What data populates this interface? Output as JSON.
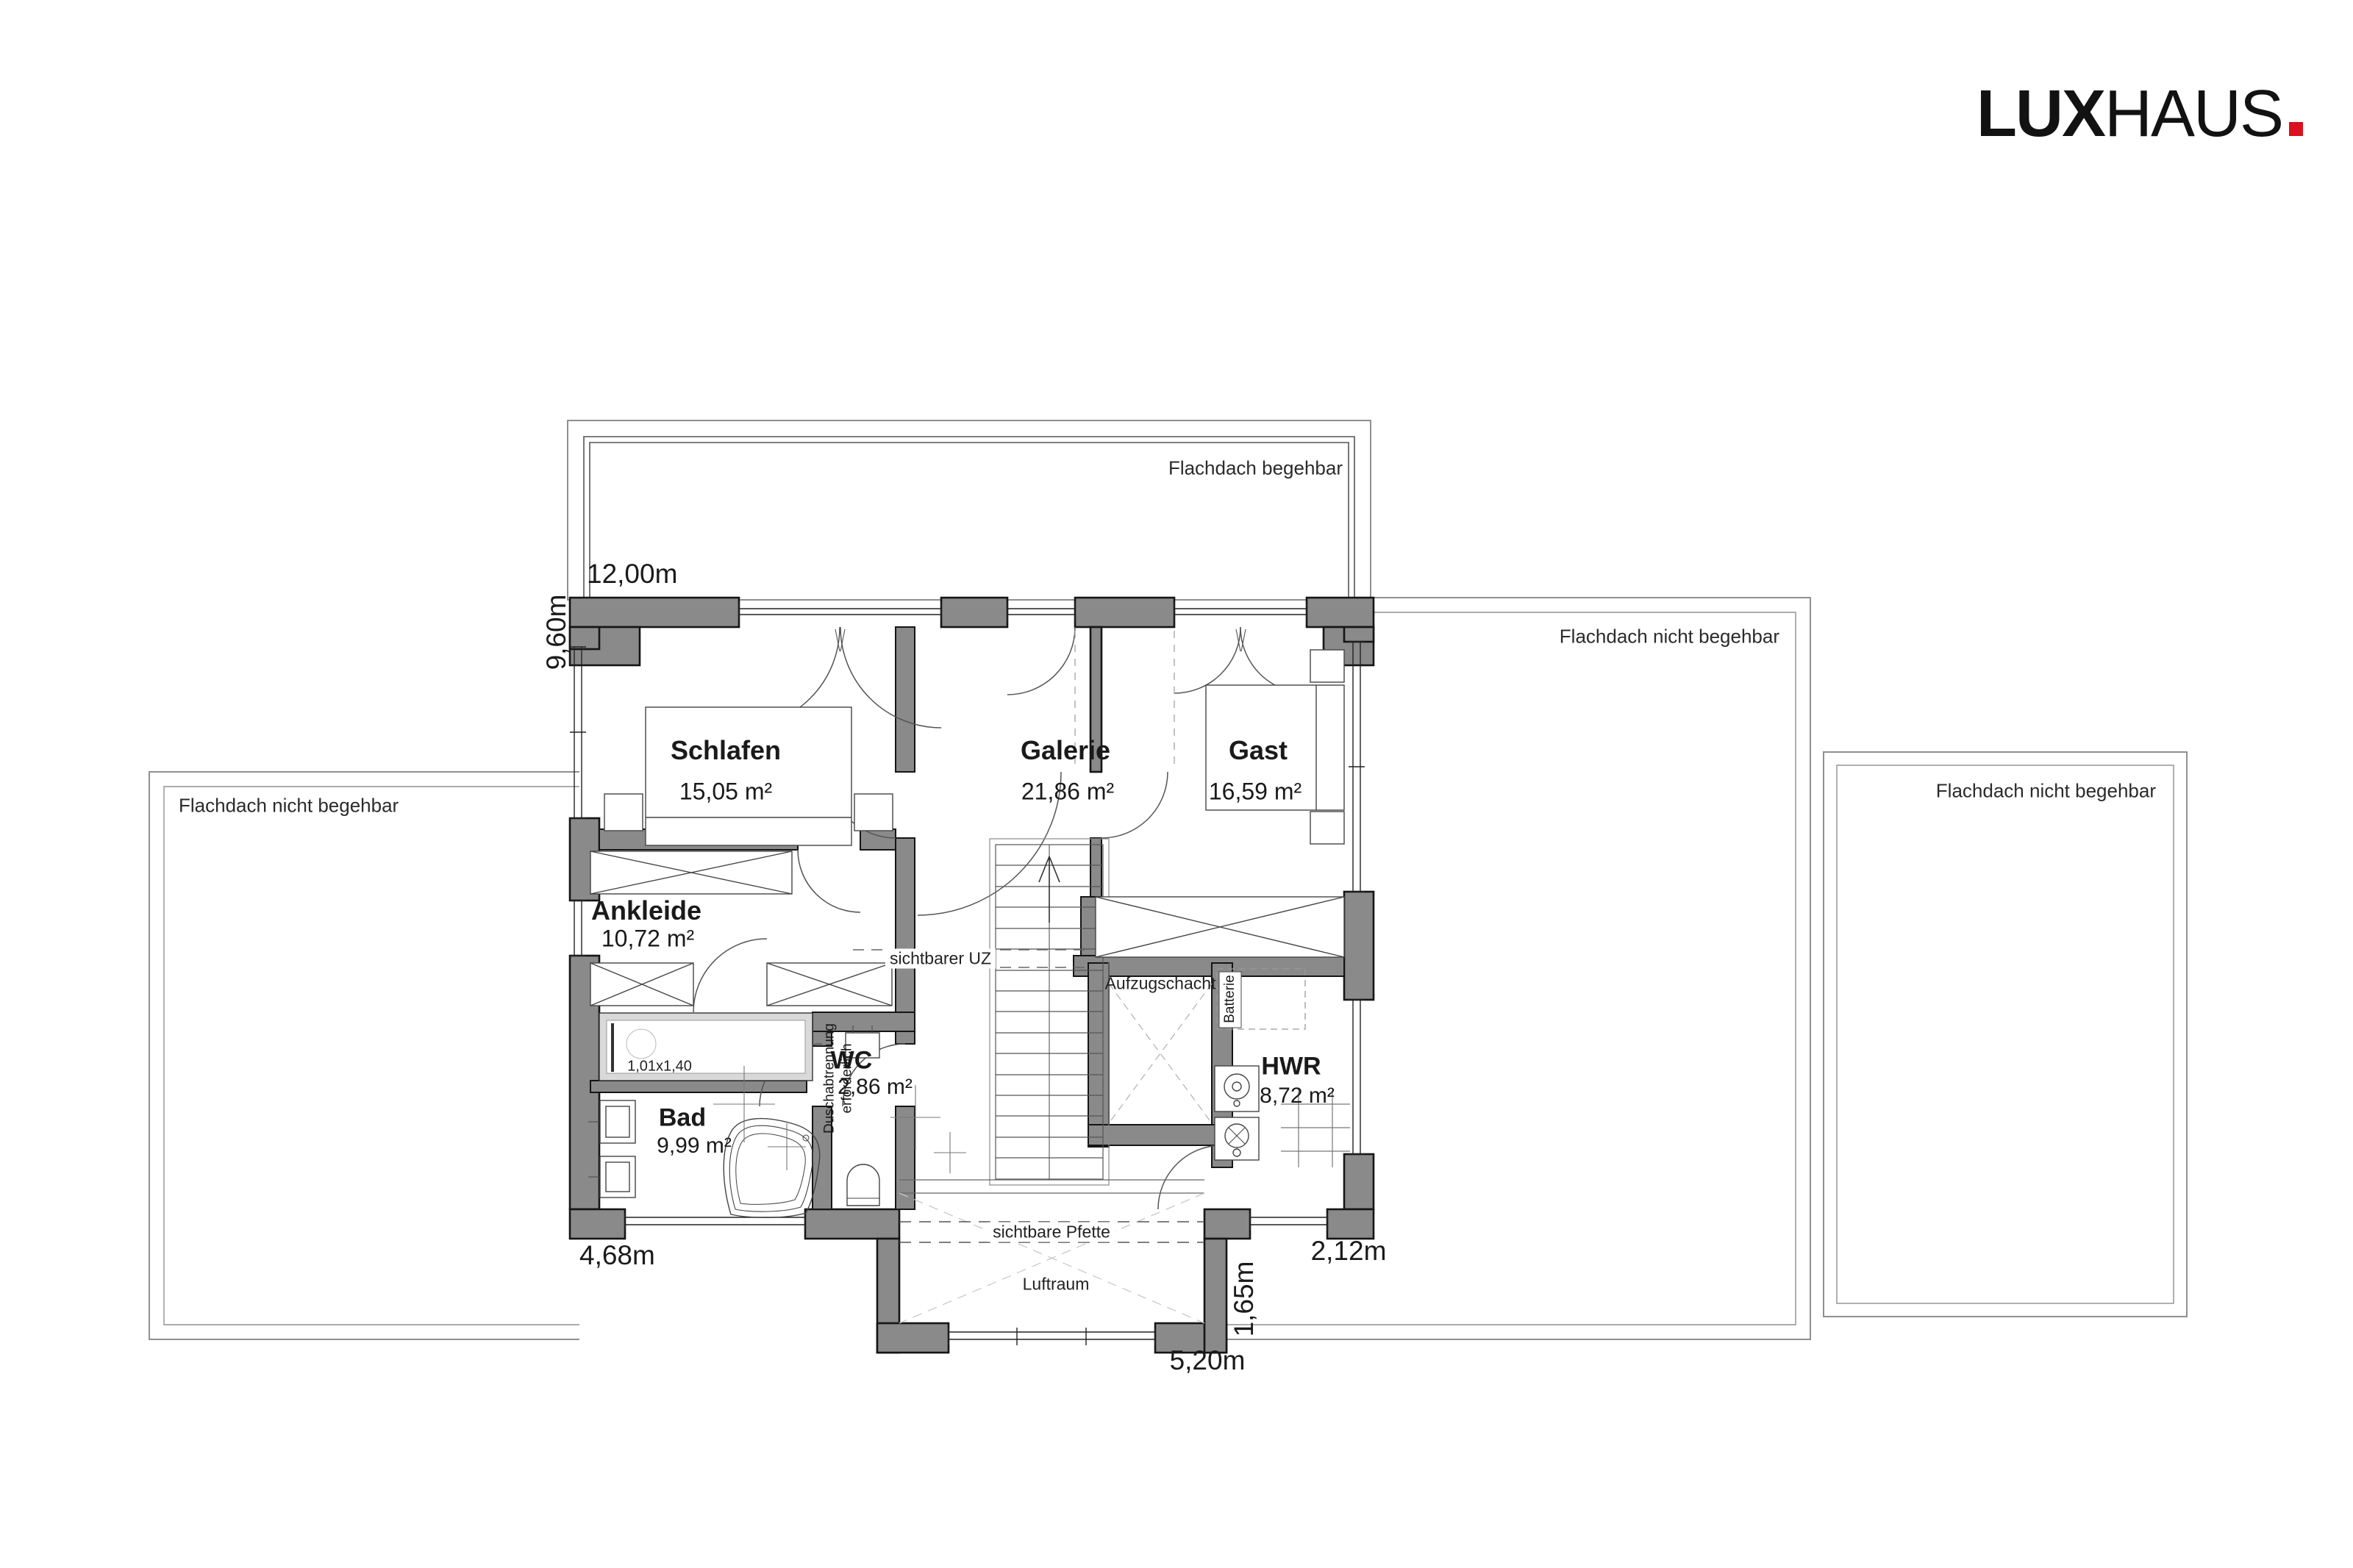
{
  "logo": {
    "lux": "LUX",
    "haus": "HAUS"
  },
  "colors": {
    "wall_fill": "#8a8a8a",
    "wall_outline": "#151515",
    "logo_red": "#dc101e",
    "shower_fill": "#d9d9d9"
  },
  "roofs": {
    "top": "Flachdach begehbar",
    "left": "Flachdach nicht begehbar",
    "right": "Flachdach nicht begehbar",
    "far_right": "Flachdach nicht begehbar"
  },
  "rooms": {
    "schlafen": {
      "name": "Schlafen",
      "area": "15,05 m²"
    },
    "galerie": {
      "name": "Galerie",
      "area": "21,86 m²"
    },
    "gast": {
      "name": "Gast",
      "area": "16,59 m²"
    },
    "ankleide": {
      "name": "Ankleide",
      "area": "10,72 m²"
    },
    "wc": {
      "name": "WC",
      "area": "2,86 m²"
    },
    "bad": {
      "name": "Bad",
      "area": "9,99 m²"
    },
    "hwr": {
      "name": "HWR",
      "area": "8,72 m²"
    }
  },
  "annotations": {
    "uz": "sichtbarer UZ",
    "aufzugschacht": "Aufzugschacht",
    "batterie": "Batterie",
    "pfette": "sichtbare Pfette",
    "luftraum": "Luftraum",
    "dusch1": "Duschabtrennung",
    "dusch2": "erforderlich",
    "shower_size": "1,01x1,40"
  },
  "dimensions": {
    "top": "12,00m",
    "left": "9,60m",
    "bottom_left": "4,68m",
    "bottom_center": "5,20m",
    "bottom_right": "2,12m",
    "right_vertical": "1,65m"
  }
}
